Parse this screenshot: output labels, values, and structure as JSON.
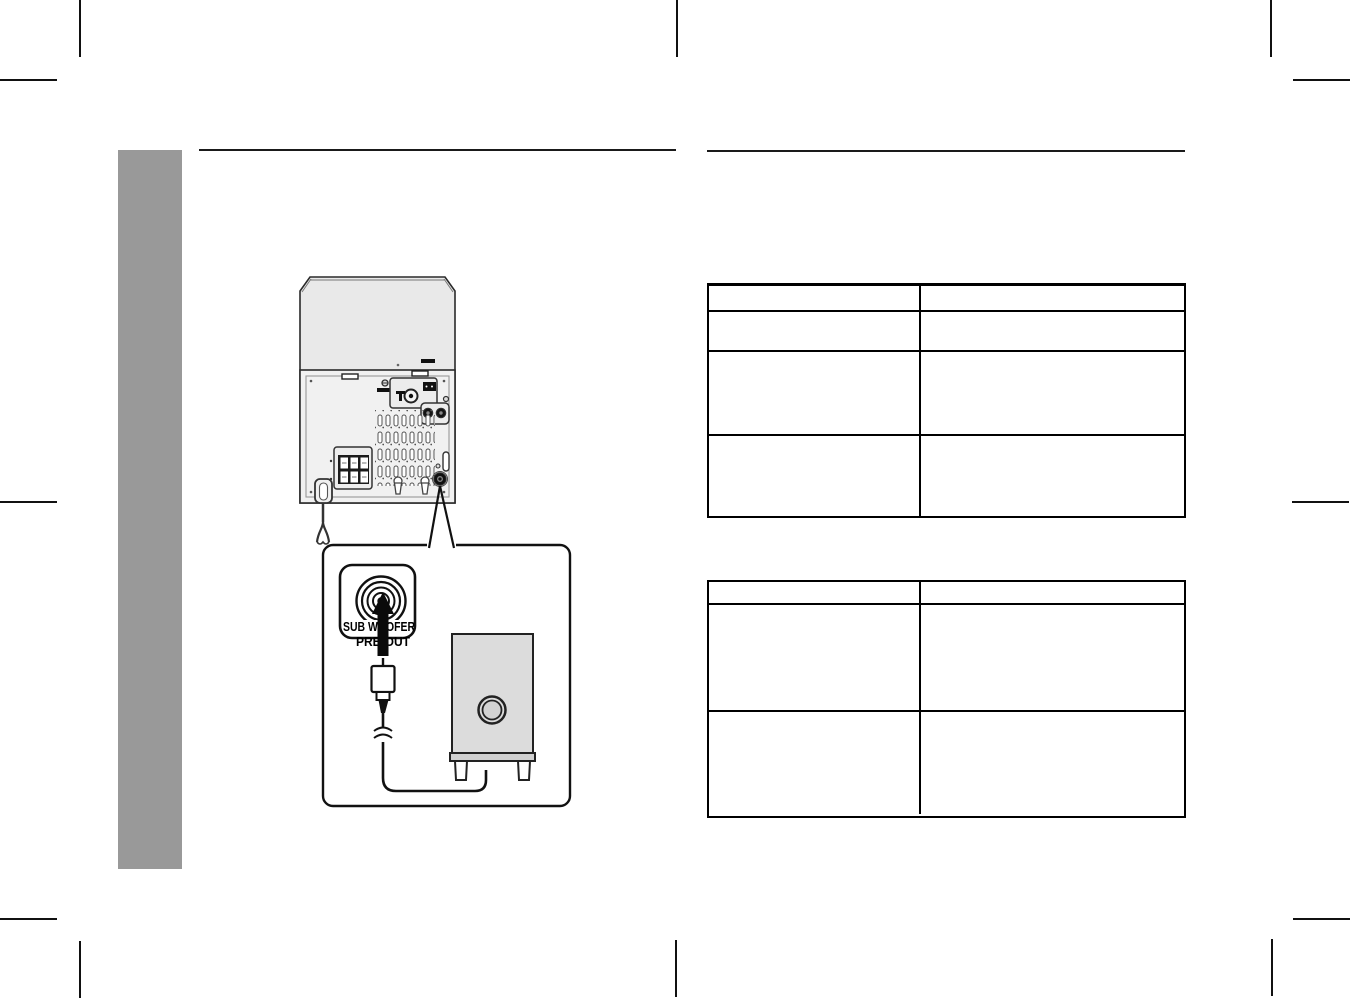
{
  "page": {
    "kind": "audio-system-manual-page",
    "visible_text": [
      "SUB WOOFER",
      "PRE-OUT"
    ]
  },
  "diagram": {
    "jack_label_line1": "SUB WOOFER",
    "jack_label_line2": "PRE-OUT",
    "components": [
      "stereo-system-rear-panel",
      "subwoofer-pre-out-jack",
      "rca-plug",
      "audio-cable",
      "subwoofer-speaker"
    ]
  },
  "tables": {
    "table1": {
      "columns": 2,
      "rows": 4,
      "cells_empty": true
    },
    "table2": {
      "columns": 2,
      "rows": 3,
      "cells_empty": true
    }
  },
  "colors": {
    "sidebar": "#999999",
    "unit_top": "#e9e9e9",
    "unit_panel": "#f1f1f1",
    "subwoofer_fill": "#dcdcdc",
    "line": "#1a1a1a"
  }
}
